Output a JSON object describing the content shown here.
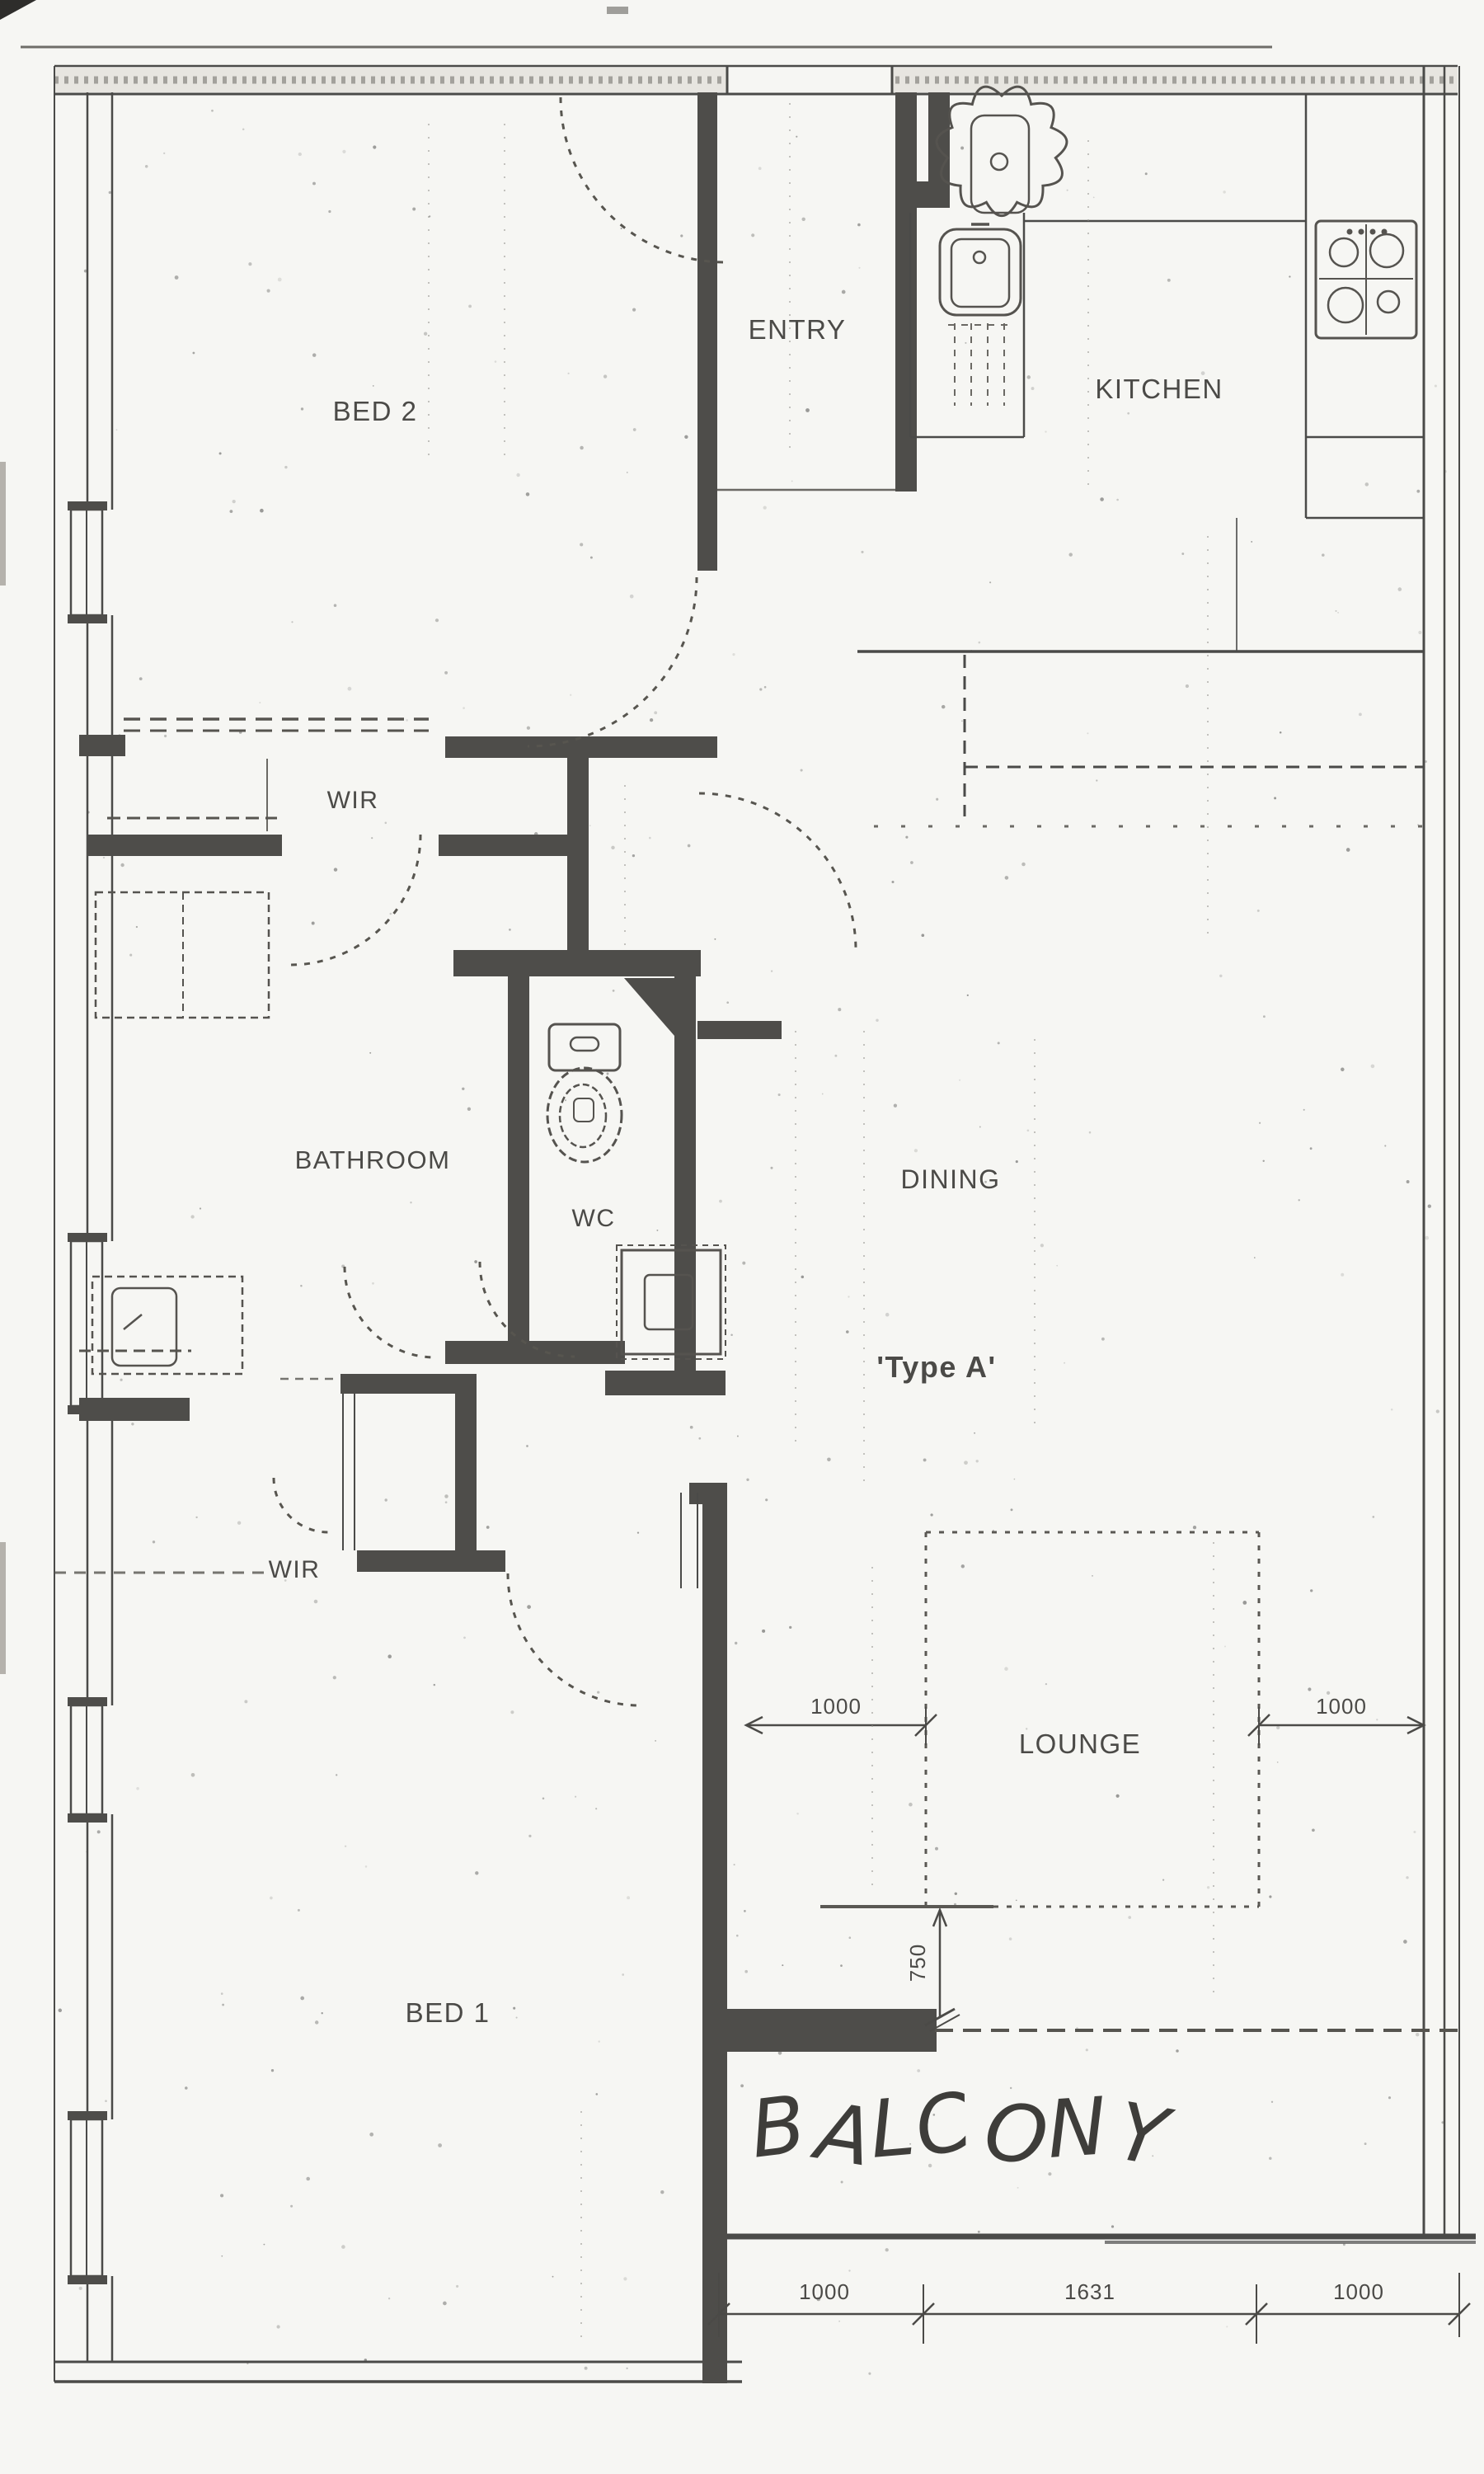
{
  "floor_plan": {
    "rooms": {
      "bed2": "BED 2",
      "entry": "ENTRY",
      "kitchen": "KITCHEN",
      "wir_upper": "WIR",
      "bathroom": "BATHROOM",
      "wc": "WC",
      "dining": "DINING",
      "unit_type": "'Type A'",
      "wir_lower": "WIR",
      "lounge": "LOUNGE",
      "bed1": "BED 1",
      "balcony": "BALCONY"
    },
    "dimensions": {
      "lounge_left": "1000",
      "lounge_right": "1000",
      "balcony_depth": "750",
      "bottom_left": "1000",
      "bottom_middle": "1631",
      "bottom_right": "1000"
    },
    "colors": {
      "ink": "#4a4a48",
      "wall_fill": "#4e4d4a",
      "paper": "#f6f6f3"
    }
  }
}
